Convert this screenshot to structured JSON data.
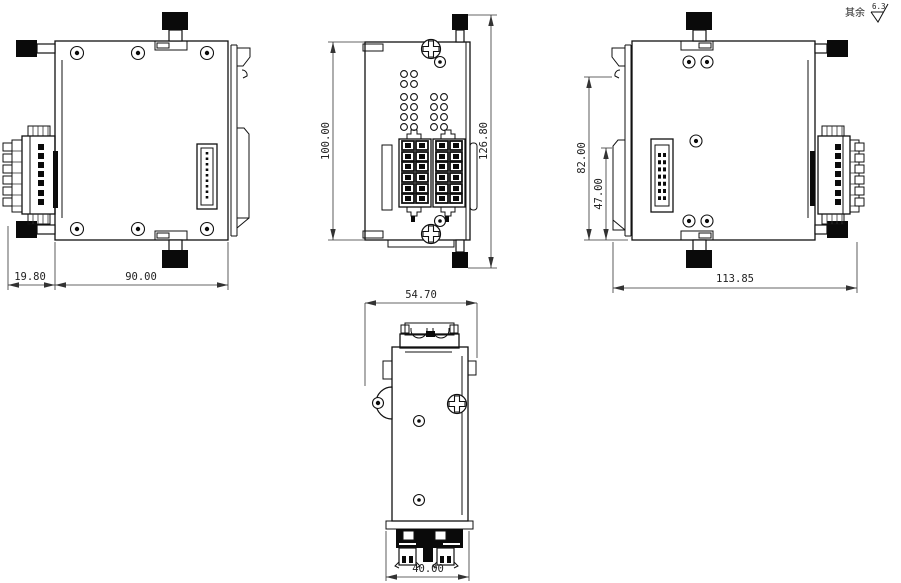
{
  "drawing": {
    "background": "#ffffff",
    "line_color": "#111111",
    "note": {
      "prefix": "其余",
      "roughness_value": "6.3"
    },
    "views": {
      "left_side": {
        "dims": {
          "connector_depth": "19.80",
          "body_width": "90.00"
        }
      },
      "front": {
        "dims": {
          "body_height": "100.00",
          "overall_height": "126.80"
        }
      },
      "right_side": {
        "dims": {
          "upper_height": "82.00",
          "lower_height": "47.00",
          "overall_width": "113.85"
        }
      },
      "bottom": {
        "dims": {
          "overall_width": "54.70",
          "terminal_width": "40.00"
        }
      }
    }
  }
}
